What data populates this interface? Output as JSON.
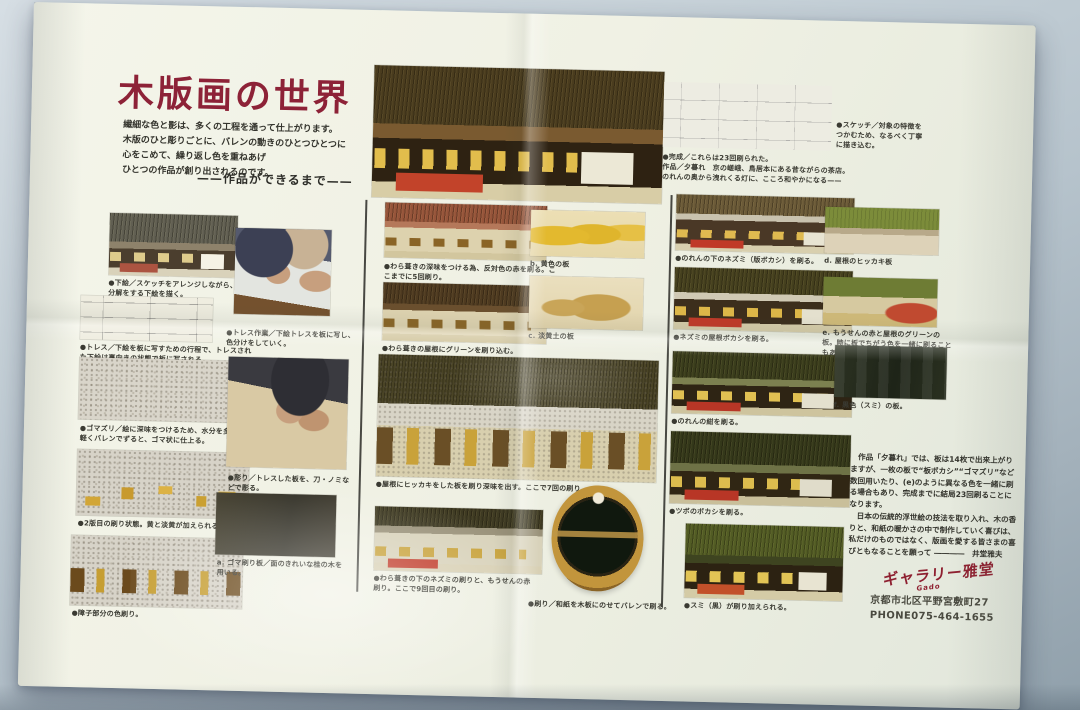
{
  "header": {
    "title": "木版画の世界",
    "intro": "繊細な色と影は、多くの工程を通って仕上がります。\n木版のひと彫りごとに、バレンの動きのひとつひとつに\n心をこめて、繰り返し色を重ねあげ\nひとつの作品が創り出されるのです。",
    "subtitle": "——作品ができるまで——",
    "sketch_caption": "●スケッチ／対象の特徴を\nつかむため、なるべく丁寧\nに描き込む。",
    "completion_caption": "●完成／これらは23回刷られた。\n作品／夕暮れ　京の嵯峨、鳥居本にある昔ながらの茶店。\nのれんの奥から洩れくる灯に、こころ和やかになる——"
  },
  "captions": {
    "s1": "●下絵／スケッチをアレンジしながら、色の分解をする下絵を描く。",
    "s2": "●トレス／下絵を板に写すための行程で、トレスされた下絵は裏向きの状態で板に写される。",
    "s3": "●ゴマズリ／絵に深味をつけるため、水分を多くし、軽くバレンでずると、ゴマ状に仕上る。",
    "s4": "●2版目の刷り状態。黄と淡黄が加えられる。",
    "s5": "●障子部分の色刷り。",
    "p1": "●トレス作業／下絵トレスを板に写し、色分けをしていく。",
    "p2": "●彫り／トレスした板を、刀・ノミなどで彫る。",
    "p3": "a. ゴマ刷り板／面のきれいな桂の木を用いる。",
    "m1": "●わら葺きの深味をつける為、反対色の赤を刷る。ここまでに5回刷り。",
    "m2": "●わら葺きの屋根にグリーンを刷り込む。",
    "m3": "●屋根にヒッカキをした板を刷り深味を出す。ここで7回の刷り。",
    "m4": "●わら葺きの下のネズミの刷りと、もうせんの赤刷り。ここで9回目の刷り。",
    "b": "b. 黄色の板",
    "c": "c. 淡黄土の板",
    "baren": "●刷り／和紙を木板にのせてバレンで刷る。",
    "r1": "●のれんの下のネズミ（版ボカシ）を刷る。",
    "r2": "●ネズミの屋根ボカシを刷る。",
    "r3": "●のれんの紺を刷る。",
    "r4": "●ツボのボカシを刷る。",
    "r5": "●スミ（黒）が刷り加えられる。",
    "d": "d. 屋根のヒッカキ板",
    "e": "e. もうせんの赤と屋根のグリーンの板。時に板でちがう色を一緒に刷ることもある。",
    "f": "f. 黒色（スミ）の板。"
  },
  "closing": {
    "paragraph": "　作品「夕暮れ」では、板は14枚で出来上がりますが、一枚の板で“板ボカシ”“ゴマズリ”など数回用いたり、(e)のように異なる色を一緒に刷る場合もあり、完成までに結局23回刷ることになります。\n　日本の伝統的浮世絵の技法を取り入れ、木の香りと、和紙の暖かさの中で制作していく喜びは、私だけのものではなく、版画を愛する皆さまの喜びともなることを願って ――――　井堂雅夫"
  },
  "footer": {
    "logo": "ギャラリー雅堂",
    "logo_sub": "Gado",
    "address": "京都市北区平野宮敷町27\nPHONE075-464-1655"
  },
  "colors": {
    "title_red": "#8d2237",
    "stamp_red": "#8e2030",
    "paper": "#f0f1e4",
    "table_blue": "#b6c3cc"
  }
}
